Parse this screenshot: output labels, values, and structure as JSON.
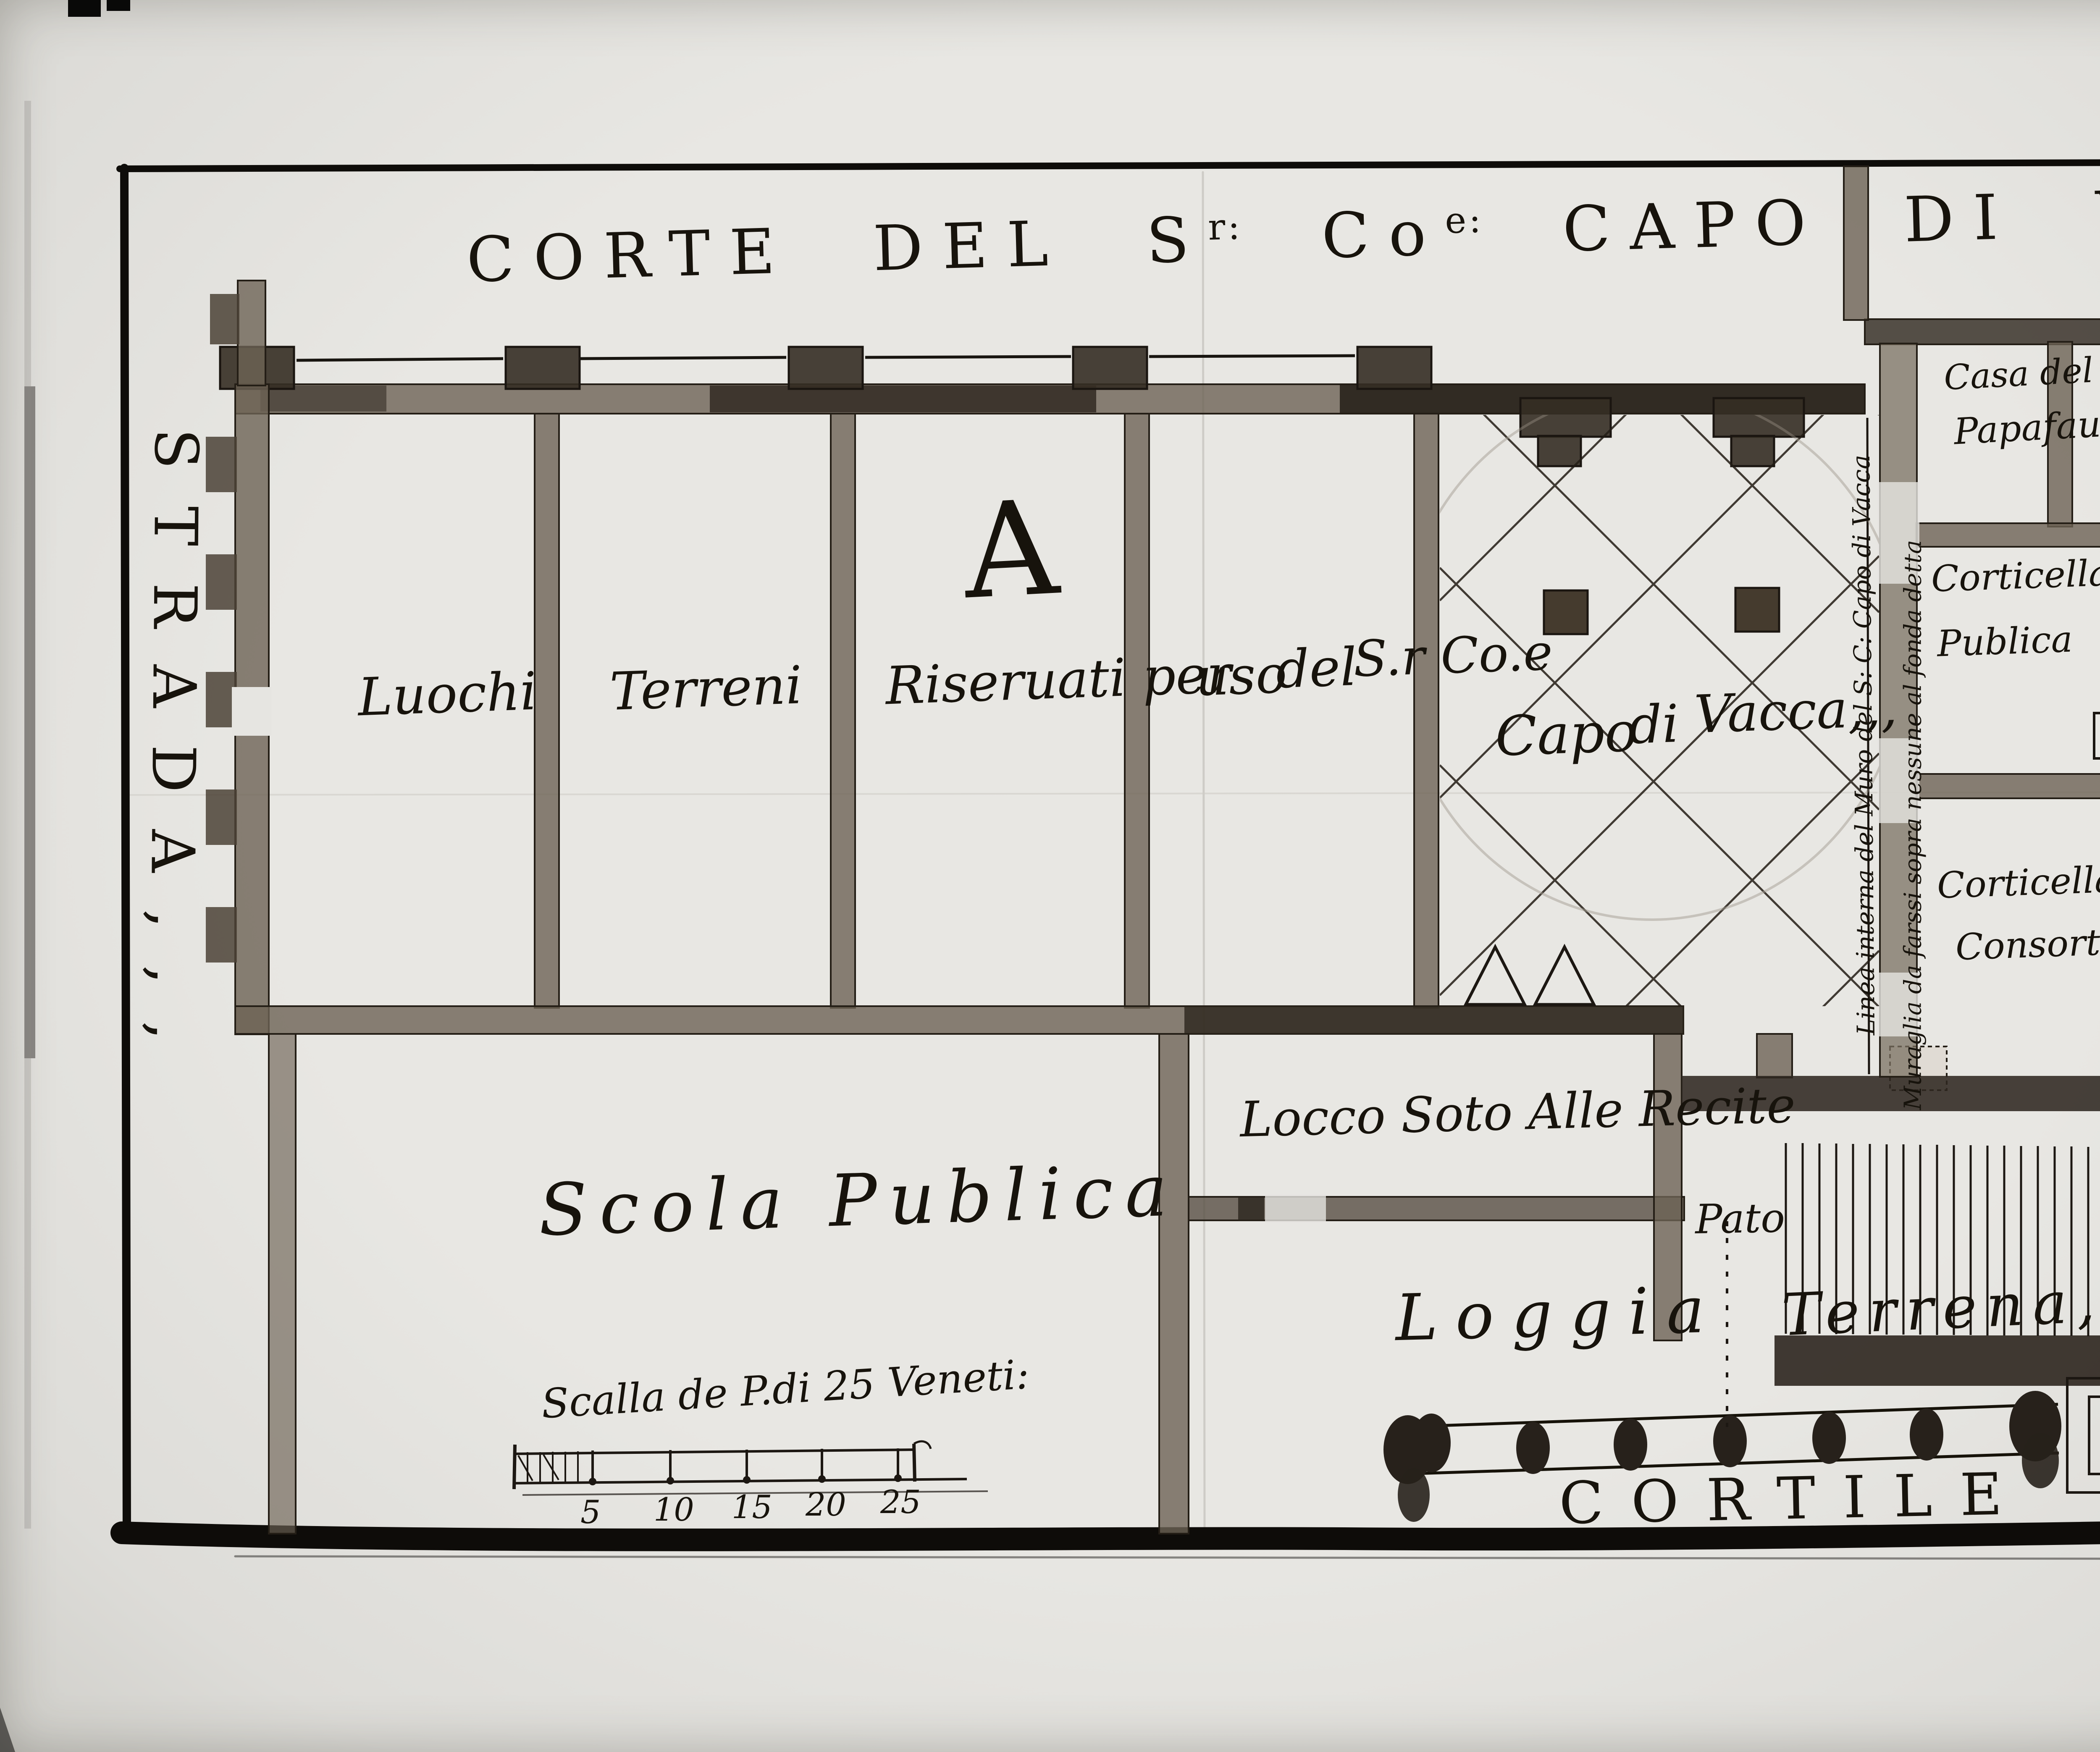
{
  "plan": {
    "title": {
      "p1": "CORTE DEL S",
      "s1": "r:",
      "p2": " Co",
      "s2": "e:",
      "p3": " CAPO DI VACCA ,,,"
    },
    "strada": "STRADA,,,",
    "marker_a": "A",
    "room_phrase": [
      "Luochi",
      "Terreni",
      "Riseruati per",
      "uso",
      "del",
      "S.r Co.e",
      "Capo",
      "di",
      "Vacca,,,"
    ],
    "casa_line1": "Casa del N.H.",
    "casa_line2": "Papafaua",
    "corticella_publica_line1": "Corticella",
    "corticella_publica_line2": "Publica",
    "corticella_consortiva_line1": "Corticella",
    "corticella_consortiva_line2": "Consortiua",
    "linea_interna": "Linea interna del Muro del S: C: Capo di Vacca",
    "muraglia": "Muraglia da farssi sopra nessune al fonda detta",
    "locco": "Locco Soto Alle Recite",
    "pato": "Pato",
    "scola": "Scola Publica",
    "loggia": "Loggia",
    "terrena": "Terrena,,,",
    "cortile": "CORTILE",
    "scale_bar": {
      "caption": "Scalla de P.di 25 Veneti:",
      "ticks": [
        "5",
        "10",
        "15",
        "20",
        "25"
      ]
    },
    "stamp": {
      "line1": "M.Danesin",
      "line2": "Padova"
    }
  }
}
